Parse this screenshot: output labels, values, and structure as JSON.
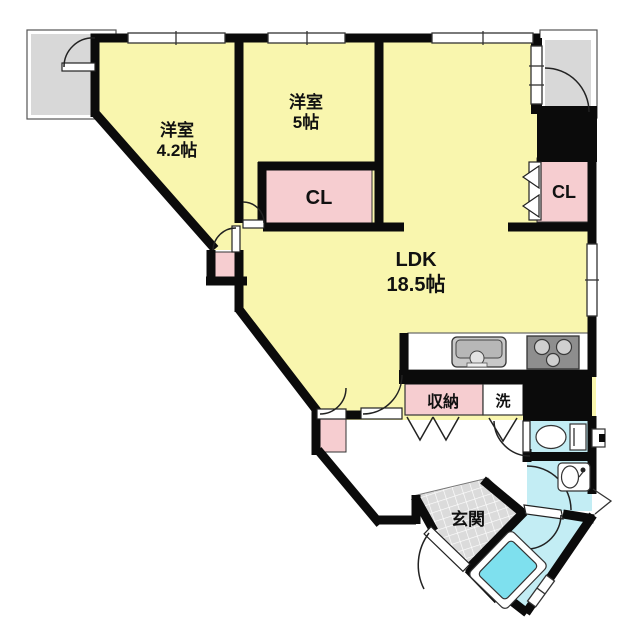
{
  "floorplan": {
    "rooms": {
      "bedroom_1": {
        "name": "洋室",
        "size": "4.2帖"
      },
      "bedroom_2": {
        "name": "洋室",
        "size": "5帖"
      },
      "ldk": {
        "name": "LDK",
        "size": "18.5帖"
      },
      "closet_middle": {
        "label": "CL"
      },
      "closet_right": {
        "label": "CL"
      },
      "storage": {
        "label": "収納"
      },
      "laundry": {
        "label": "洗"
      },
      "entrance": {
        "label": "玄関"
      }
    },
    "colors": {
      "room_fill": "#F9F6AE",
      "closet_fill": "#F6CDD0",
      "wet_area_fill": "#C3EDF4",
      "bathtub_fill": "#7EE0EE",
      "balcony_fill": "#D8D8D8",
      "entrance_fill": "#DBDBDB",
      "counter_fill": "#FFFFFF",
      "stove_fill": "#8E8E8E",
      "wall": "#0B0B0B"
    },
    "fixtures": [
      "kitchen-sink",
      "gas-stove",
      "toilet",
      "washbasin",
      "bathtub"
    ]
  }
}
